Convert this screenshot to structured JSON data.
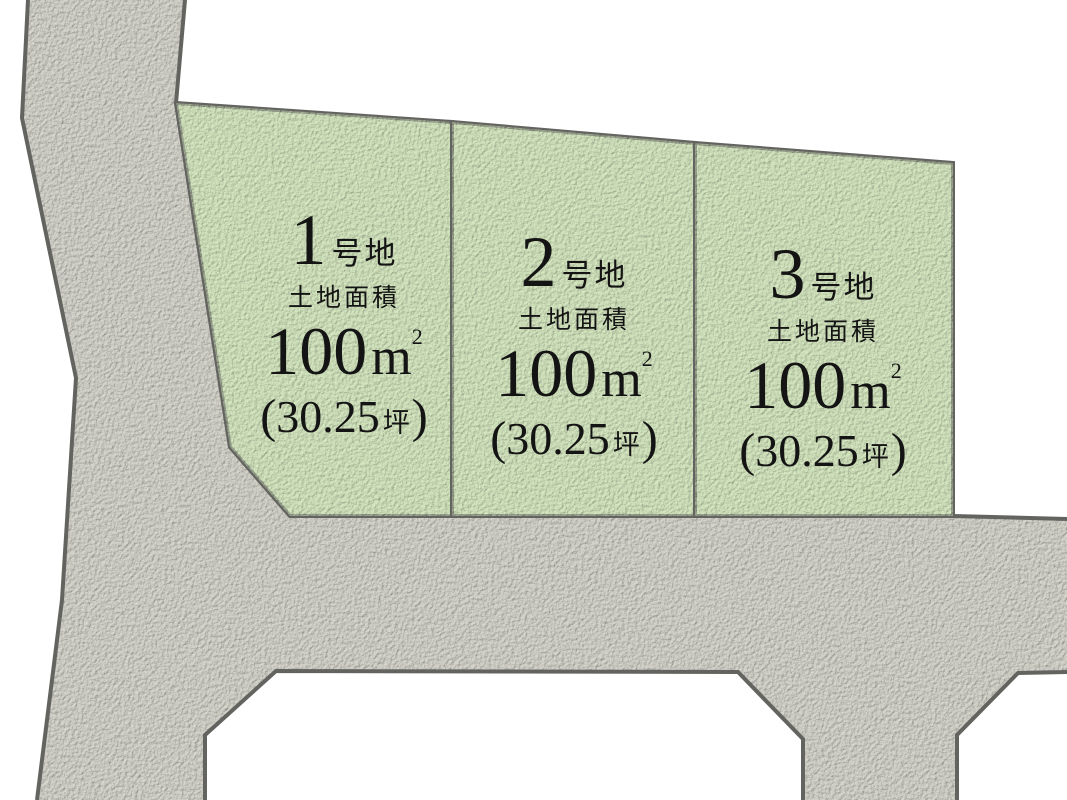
{
  "diagram_type": "land-plot-site-plan",
  "colors": {
    "background": "#ffffff",
    "road_fill": "#d9d8cf",
    "plot_fill": "#d7e9c2",
    "border": "#636360",
    "text": "#141414"
  },
  "plots": [
    {
      "name_number": "1",
      "name_suffix": "号地",
      "area_caption": "土地面積",
      "area_value": "100",
      "area_unit_base": "m",
      "area_unit_sup": "2",
      "tsubo_open": "(",
      "tsubo_value": "30.25",
      "tsubo_unit": "坪",
      "tsubo_close": ")"
    },
    {
      "name_number": "2",
      "name_suffix": "号地",
      "area_caption": "土地面積",
      "area_value": "100",
      "area_unit_base": "m",
      "area_unit_sup": "2",
      "tsubo_open": "(",
      "tsubo_value": "30.25",
      "tsubo_unit": "坪",
      "tsubo_close": ")"
    },
    {
      "name_number": "3",
      "name_suffix": "号地",
      "area_caption": "土地面積",
      "area_value": "100",
      "area_unit_base": "m",
      "area_unit_sup": "2",
      "tsubo_open": "(",
      "tsubo_value": "30.25",
      "tsubo_unit": "坪",
      "tsubo_close": ")"
    }
  ]
}
